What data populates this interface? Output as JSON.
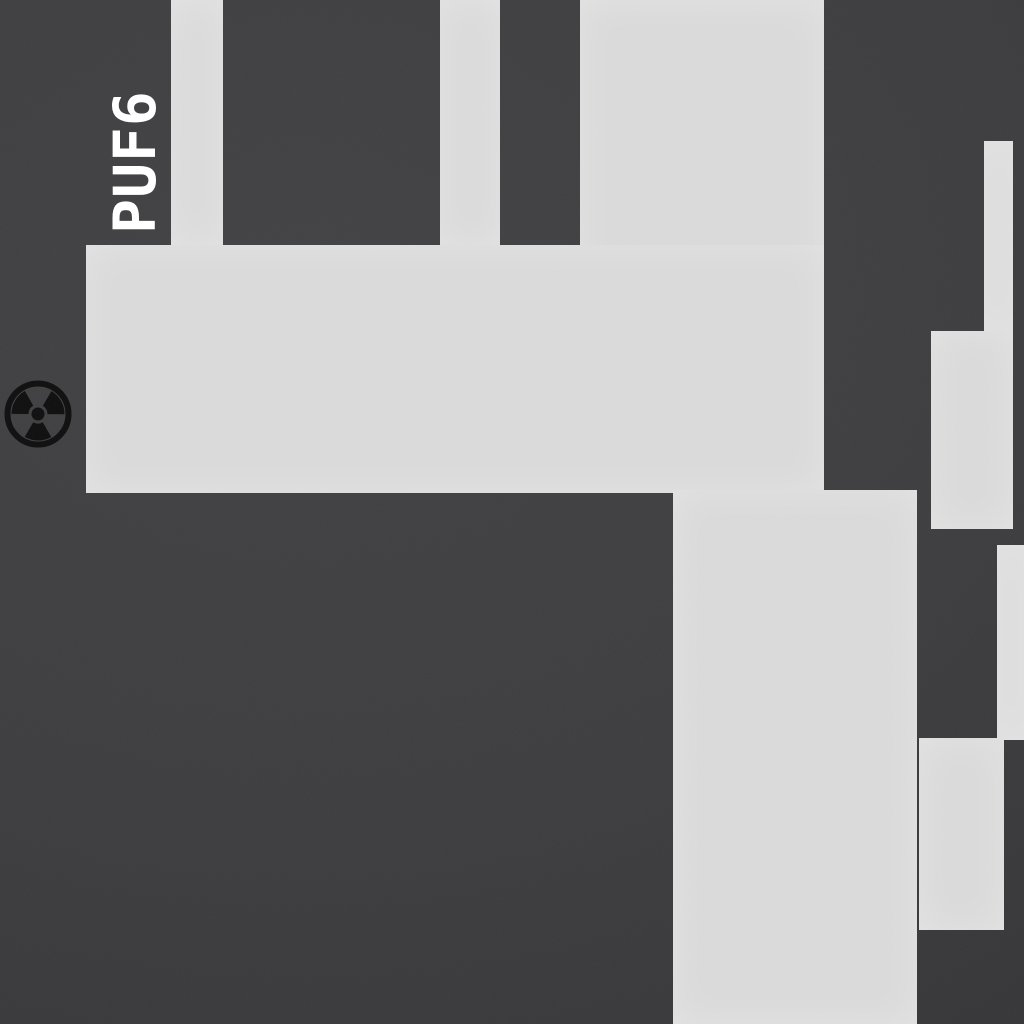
{
  "scene": {
    "type": "top-down-game-map",
    "label": {
      "text": "PUF6",
      "color": "#ffffff"
    },
    "colors": {
      "background": "#3a3a3c",
      "background_light": "#3f3f41",
      "background_dark": "#313133",
      "floor": "#d9d9d9",
      "icon": "#0b0b0b"
    },
    "hazard_icon": {
      "name": "radiation-icon",
      "center_x": 38,
      "center_y": 414,
      "outer_radius": 34
    }
  },
  "map": {
    "width": 1024,
    "height": 1024,
    "floor_rects": [
      {
        "name": "floor-corridor-top-left",
        "x": 171,
        "y": 0,
        "w": 52,
        "h": 246
      },
      {
        "name": "floor-corridor-top-mid",
        "x": 440,
        "y": 0,
        "w": 60,
        "h": 246
      },
      {
        "name": "floor-column-upper",
        "x": 580,
        "y": 0,
        "w": 244,
        "h": 493
      },
      {
        "name": "floor-hall-band",
        "x": 86,
        "y": 245,
        "w": 738,
        "h": 248
      },
      {
        "name": "floor-column-lower",
        "x": 673,
        "y": 490,
        "w": 244,
        "h": 534
      },
      {
        "name": "floor-corridor-right",
        "x": 984,
        "y": 141,
        "w": 29,
        "h": 191
      },
      {
        "name": "floor-room-right-upper",
        "x": 931,
        "y": 331,
        "w": 82,
        "h": 198
      },
      {
        "name": "floor-corridor-right-edge",
        "x": 997,
        "y": 545,
        "w": 27,
        "h": 195
      },
      {
        "name": "floor-room-right-lower",
        "x": 919,
        "y": 738,
        "w": 85,
        "h": 192
      }
    ]
  }
}
